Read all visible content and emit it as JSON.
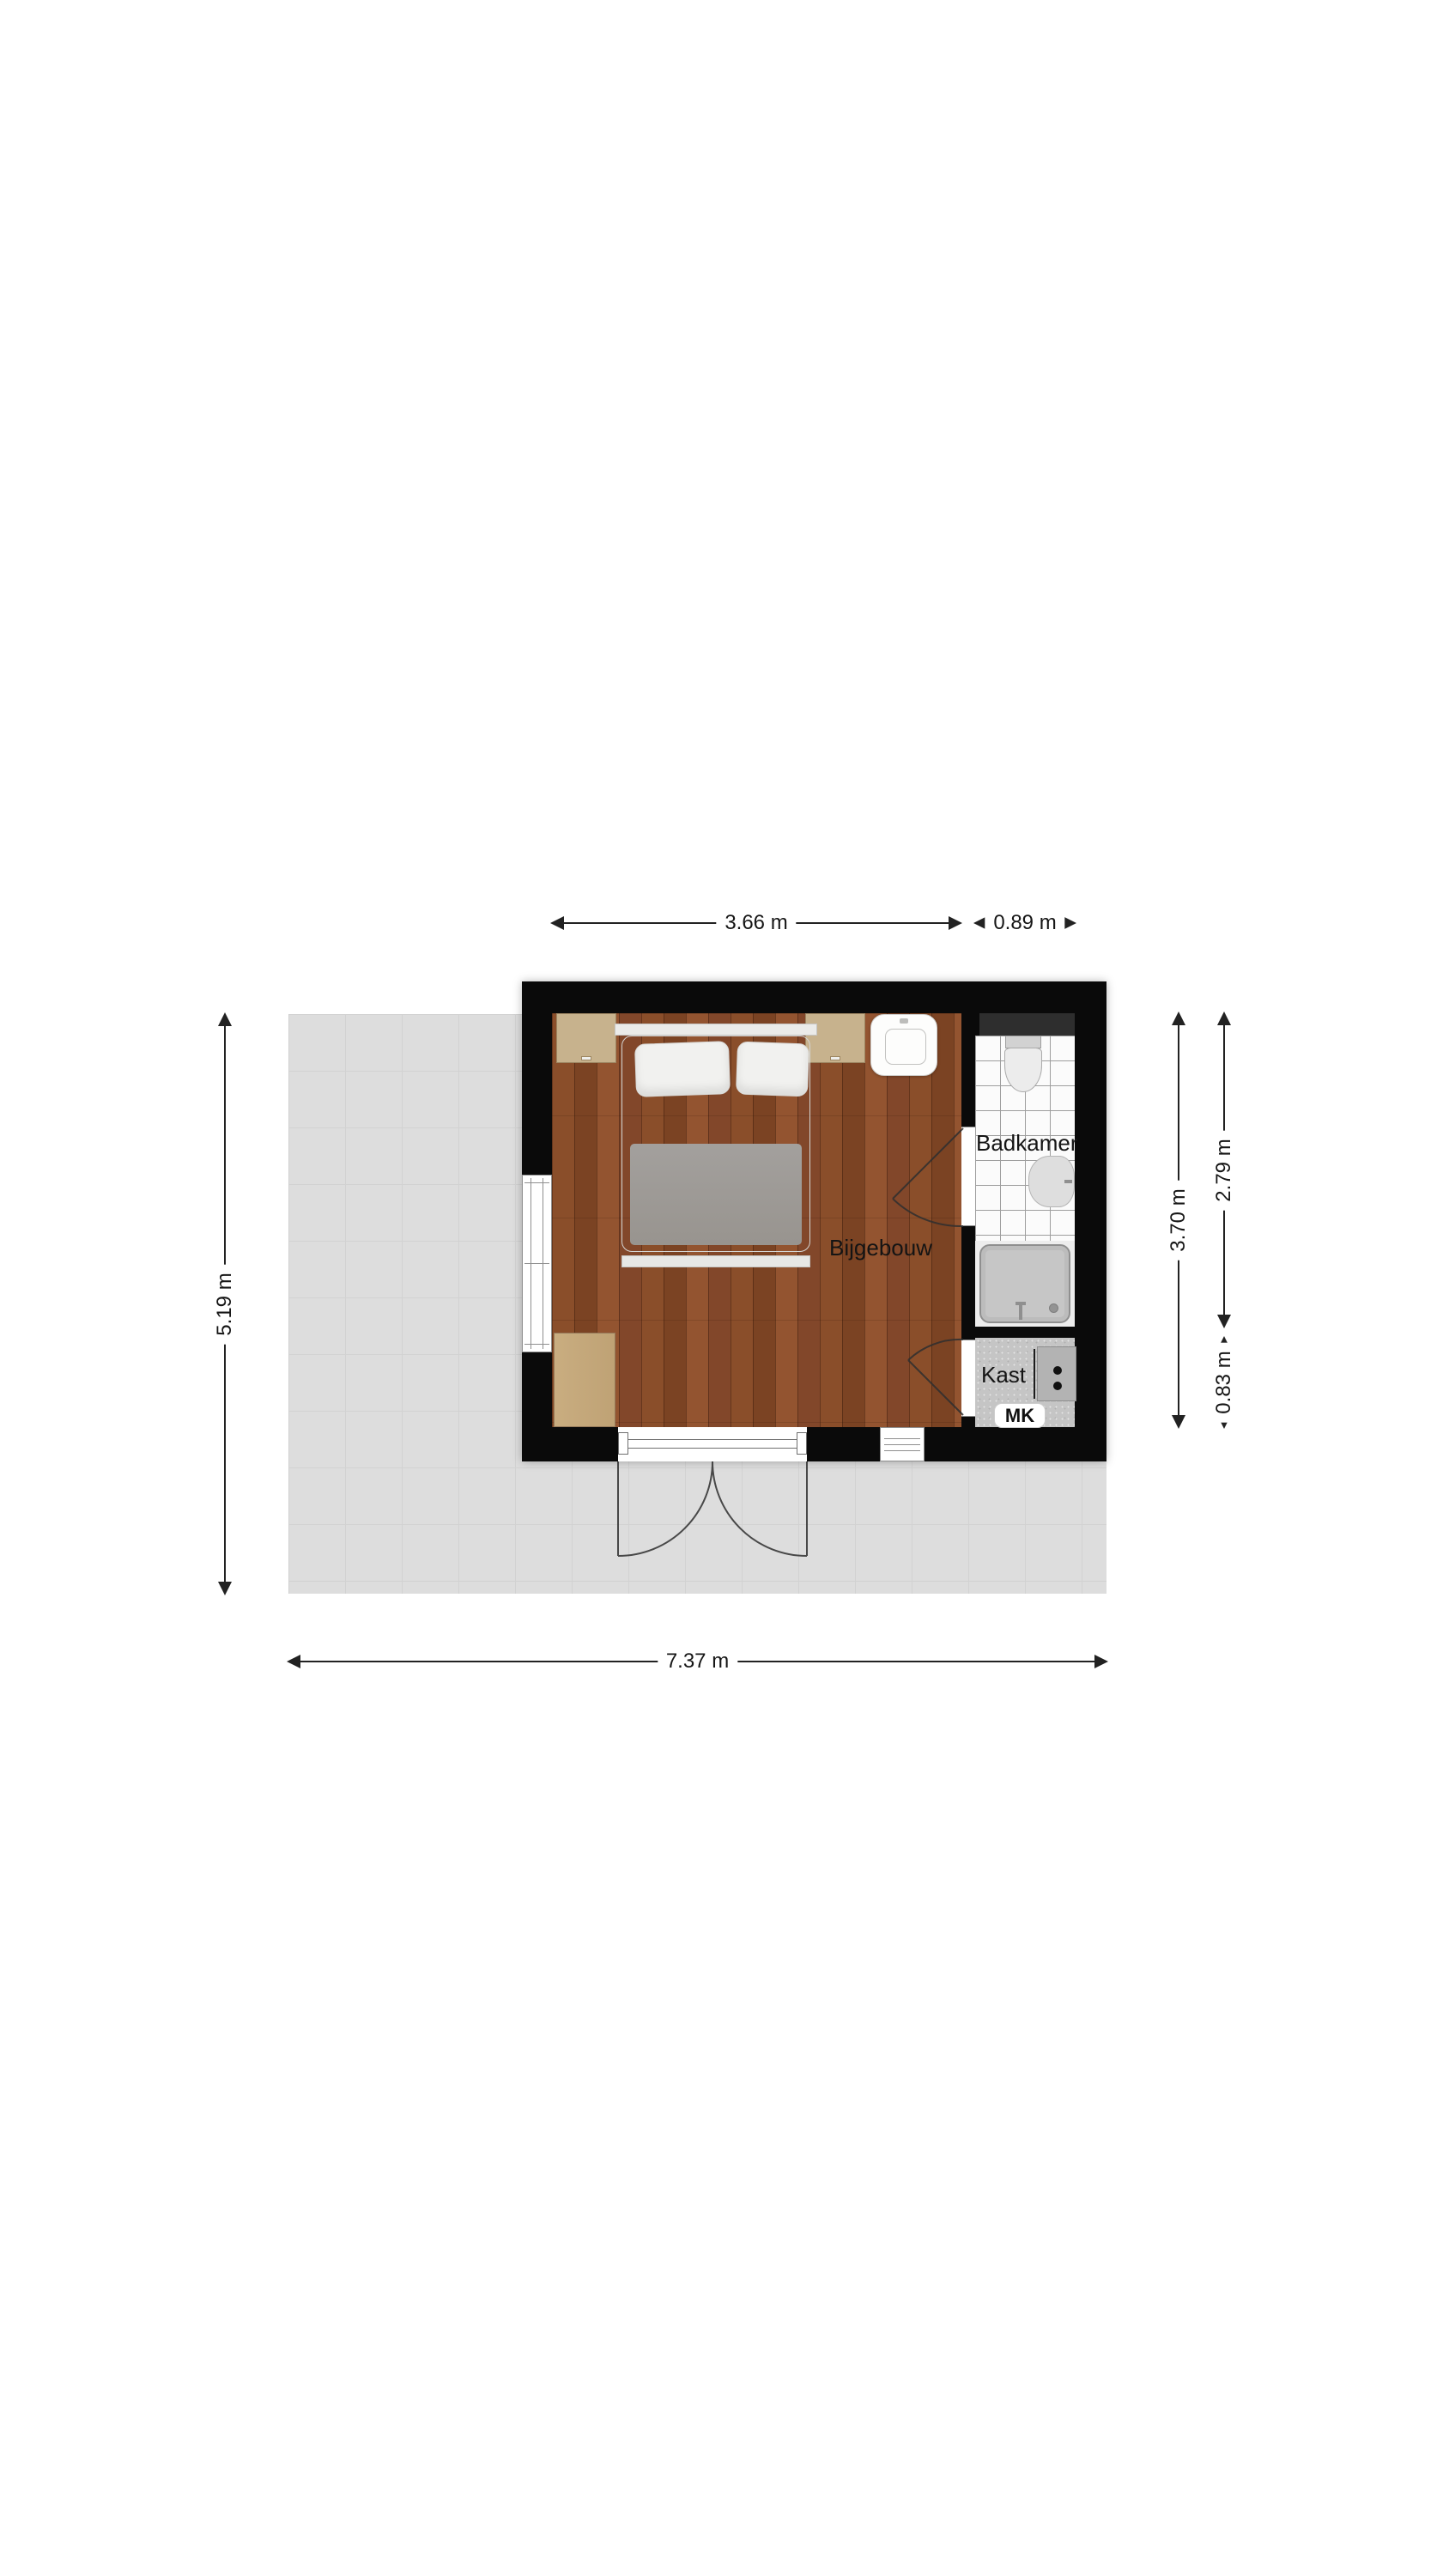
{
  "floorplan": {
    "rooms": {
      "main": "Bijgebouw",
      "bathroom": "Badkamer",
      "closet": "Kast",
      "meter_cupboard": "MK"
    },
    "dimensions": {
      "top_main": "3.66 m",
      "top_bathroom": "0.89 m",
      "left_terrace": "5.19 m",
      "right_interior": "3.70 m",
      "right_bathroom": "2.79 m",
      "right_closet": "0.83 m",
      "bottom_terrace": "7.37 m"
    },
    "icons": {
      "bed": "double-bed",
      "nightstands": "nightstand",
      "wash_basin": "wash-basin",
      "toilet": "toilet",
      "bathroom_sink": "sink",
      "shower": "shower-tray-with-drain",
      "desk": "desk-cabinet",
      "meter_panel": "electrical-panel",
      "double_door": "french-doors-swing",
      "windows": "window-frame"
    },
    "colors": {
      "wall": "#0a0a0a",
      "wood_floor": "#8a4e2a",
      "terrace": "#dddddd",
      "terrace_line": "#d2d2d2",
      "tile_white": "#fbfbfb",
      "tile_grout": "#9e9e9e",
      "closet_floor": "#c5c5c5",
      "bed_blanket": "#a3a09d",
      "furniture_wood": "#c7b28d",
      "dimension_ink": "#222222"
    }
  }
}
